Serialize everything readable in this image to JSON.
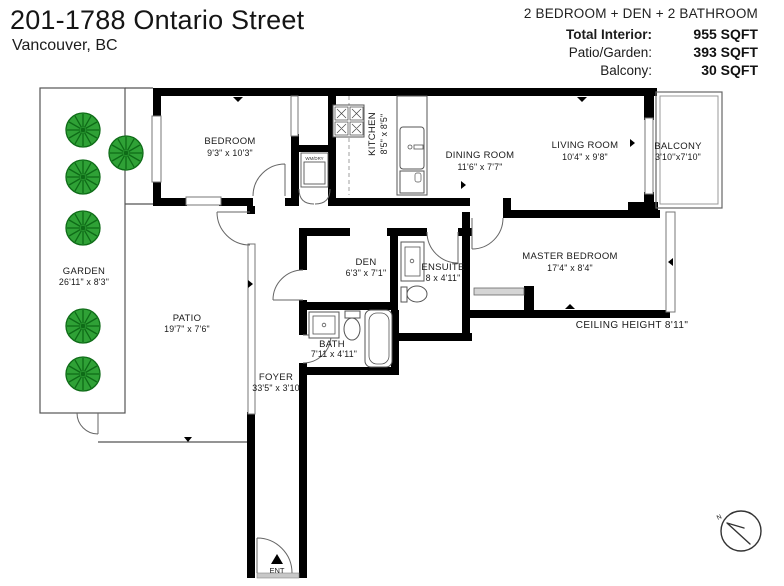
{
  "header": {
    "title": "201-1788 Ontario Street",
    "subtitle": "Vancouver, BC",
    "summary": "2 BEDROOM + DEN + 2 BATHROOM",
    "stats": [
      {
        "label": "Total Interior:",
        "value": "955 SQFT"
      },
      {
        "label": "Patio/Garden:",
        "value": "393 SQFT"
      },
      {
        "label": "Balcony:",
        "value": "30 SQFT"
      }
    ]
  },
  "floorplan": {
    "rooms": {
      "bedroom": {
        "name": "BEDROOM",
        "dims": "9'3\" x 10'3\""
      },
      "kitchen": {
        "name": "KITCHEN",
        "dims": "8'5\" x 8'5\""
      },
      "dining": {
        "name": "DINING ROOM",
        "dims": "11'6\" x 7'7\""
      },
      "living": {
        "name": "LIVING ROOM",
        "dims": "10'4\" x 9'8\""
      },
      "balcony": {
        "name": "BALCONY",
        "dims": "3'10''x7'10\""
      },
      "master": {
        "name": "MASTER BEDROOM",
        "dims": "17'4\" x 8'4\""
      },
      "ensuite": {
        "name": "ENSUITE",
        "dims": "8 x 4'11\""
      },
      "den": {
        "name": "DEN",
        "dims": "6'3\" x 7'1\""
      },
      "bath": {
        "name": "BATH",
        "dims": "7'11 x 4'11\""
      },
      "foyer": {
        "name": "FOYER",
        "dims": "33'5\" x 3'10"
      },
      "patio": {
        "name": "PATIO",
        "dims": "19'7\" x 7'6\""
      },
      "garden": {
        "name": "GARDEN",
        "dims": "26'11\" x 8'3\""
      }
    },
    "annotations": {
      "ceiling_height": "CEILING HEIGHT 8'11\"",
      "entrance": "ENT",
      "laundry_closet": "WM/DRY",
      "compass_north": "N"
    },
    "colors": {
      "wall": "#000000",
      "outline": "#555555",
      "tree_fill": "#2fa136",
      "tree_stroke": "#0e6b17"
    }
  }
}
